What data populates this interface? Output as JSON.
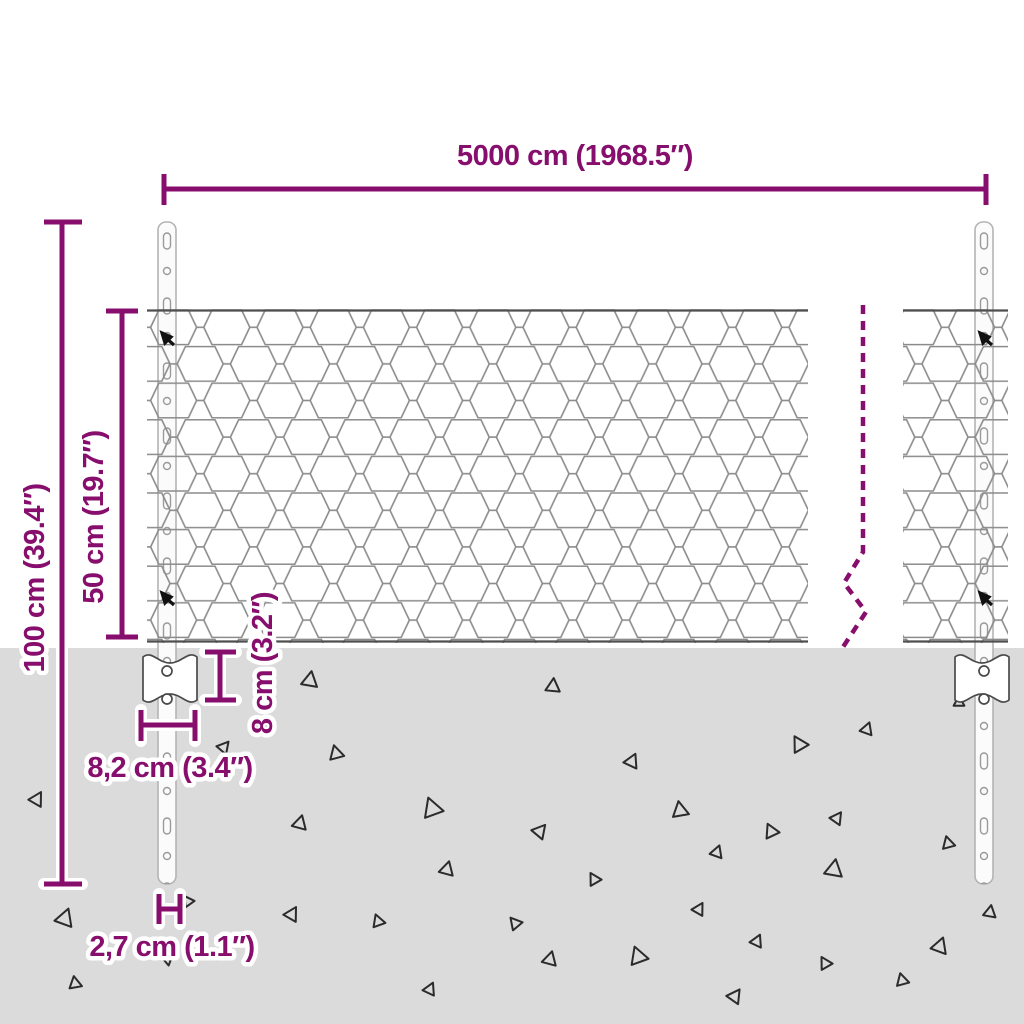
{
  "diagram": {
    "type": "fence-dimension-diagram",
    "labels": {
      "span": "5000 cm (1968.5″)",
      "total_height": "100 cm (39.4″)",
      "mesh_height": "50 cm (19.7″)",
      "anchor_height": "8 cm (3.2″)",
      "anchor_width": "8,2 cm (3.4″)",
      "post_width": "2,7 cm (1.1″)"
    },
    "colors": {
      "dimension_accent": "#870e6c",
      "ground": "#dbdbdb",
      "mesh_wire": "#8b8b8b",
      "mesh_edge": "#4f4f4f",
      "post_outline": "#b4b4b4",
      "plate_outline": "#4a4a4a",
      "triangle_mark": "#2b2b2b"
    },
    "decor": {
      "triangles": [
        {
          "x": 310,
          "y": 680,
          "s": 9,
          "r": 10
        },
        {
          "x": 224,
          "y": 747,
          "s": 7,
          "r": 40
        },
        {
          "x": 336,
          "y": 753,
          "s": 8,
          "r": -15
        },
        {
          "x": 37,
          "y": 799,
          "s": 8,
          "r": 30
        },
        {
          "x": 432,
          "y": 808,
          "s": 11,
          "r": -20
        },
        {
          "x": 300,
          "y": 823,
          "s": 8,
          "r": 15
        },
        {
          "x": 553,
          "y": 686,
          "s": 8,
          "r": 5
        },
        {
          "x": 867,
          "y": 729,
          "s": 7,
          "r": 20
        },
        {
          "x": 799,
          "y": 744,
          "s": 9,
          "r": -30
        },
        {
          "x": 632,
          "y": 761,
          "s": 8,
          "r": 25
        },
        {
          "x": 680,
          "y": 810,
          "s": 9,
          "r": -10
        },
        {
          "x": 837,
          "y": 818,
          "s": 7,
          "r": 35
        },
        {
          "x": 771,
          "y": 831,
          "s": 8,
          "r": -25
        },
        {
          "x": 540,
          "y": 831,
          "s": 8,
          "r": 40
        },
        {
          "x": 959,
          "y": 702,
          "s": 6,
          "r": 0
        },
        {
          "x": 65,
          "y": 918,
          "s": 10,
          "r": 20
        },
        {
          "x": 188,
          "y": 901,
          "s": 6,
          "r": -35
        },
        {
          "x": 292,
          "y": 914,
          "s": 8,
          "r": 30
        },
        {
          "x": 378,
          "y": 921,
          "s": 7,
          "r": -20
        },
        {
          "x": 447,
          "y": 869,
          "s": 8,
          "r": 15
        },
        {
          "x": 168,
          "y": 959,
          "s": 6,
          "r": 50
        },
        {
          "x": 75,
          "y": 983,
          "s": 7,
          "r": -10
        },
        {
          "x": 430,
          "y": 989,
          "s": 7,
          "r": 25
        },
        {
          "x": 594,
          "y": 879,
          "s": 7,
          "r": -30
        },
        {
          "x": 717,
          "y": 852,
          "s": 7,
          "r": 20
        },
        {
          "x": 834,
          "y": 869,
          "s": 10,
          "r": 10
        },
        {
          "x": 948,
          "y": 843,
          "s": 7,
          "r": -15
        },
        {
          "x": 699,
          "y": 909,
          "s": 7,
          "r": 30
        },
        {
          "x": 515,
          "y": 923,
          "s": 7,
          "r": -40
        },
        {
          "x": 550,
          "y": 959,
          "s": 8,
          "r": 15
        },
        {
          "x": 638,
          "y": 956,
          "s": 10,
          "r": -20
        },
        {
          "x": 757,
          "y": 941,
          "s": 7,
          "r": 25
        },
        {
          "x": 825,
          "y": 963,
          "s": 7,
          "r": -30
        },
        {
          "x": 940,
          "y": 946,
          "s": 9,
          "r": 20
        },
        {
          "x": 902,
          "y": 980,
          "s": 7,
          "r": -15
        },
        {
          "x": 735,
          "y": 996,
          "s": 8,
          "r": 35
        },
        {
          "x": 990,
          "y": 912,
          "s": 7,
          "r": 10
        }
      ]
    }
  }
}
